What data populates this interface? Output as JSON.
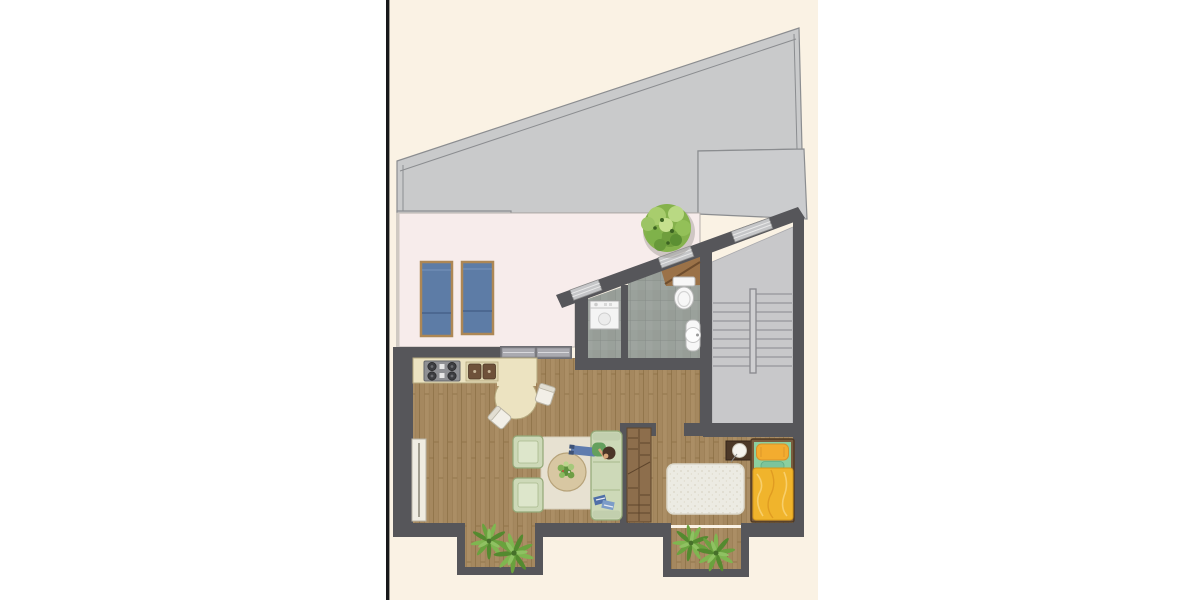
{
  "document": {
    "type": "architectural-floor-plan-render",
    "view": "top-down color floor plan of a small apartment with roof terrace",
    "visible_text": "none",
    "page_background": "#ffffff",
    "canvas_background": "#faf2e4",
    "divider_line_color": "#17171a"
  },
  "palette": {
    "wall": "#56565a",
    "roof": "#c9cacb",
    "roof_panel": "#cbccce",
    "roof_stroke": "#8b8d90",
    "terrace_floor": "#f7eceb",
    "wood_floor_base": "#a5885f",
    "tile_floor": "#9aa19b",
    "stair_floor": "#c8c8ca",
    "counter_cream": "#ece3c1",
    "green_furniture": "#cdd9b8",
    "green_furniture_border": "#93a877",
    "rug_beige": "#e7e1d1",
    "rug_white": "#ecebe3",
    "bed_yellow": "#f0b42c",
    "pillow_yellow": "#f3ac2f",
    "sheet_green": "#8ccf9f",
    "lounger_blue": "#5d7ca6",
    "lounger_frame": "#ad8755",
    "wardrobe_brown": "#8d6e4c",
    "nightstand_brown": "#4c3828",
    "door_brown": "#9b7248",
    "plant_green": "#6aa23e",
    "tree_green": "#85b24c",
    "white_fixture": "#f7f7f7"
  },
  "rooms": [
    {
      "id": "roof",
      "name": "sloped roof / covered area",
      "floor": "roof panels",
      "items": [
        "main sloped roof",
        "left roof panel",
        "right roof panel",
        "parapet edge lines"
      ]
    },
    {
      "id": "terrace",
      "name": "roof terrace",
      "floor": "pale pink screed",
      "items": [
        "sun lounger",
        "sun lounger",
        "potted tree"
      ]
    },
    {
      "id": "kitchen-living",
      "name": "kitchen / living room",
      "floor": "wood planks",
      "items": [
        "kitchen counter",
        "gas hob 4 burners",
        "double kitchen sink",
        "round dining table",
        "dining chair",
        "dining chair",
        "radiator",
        "armchair",
        "armchair",
        "beige rug",
        "round coffee table with plant",
        "sofa",
        "person lying on sofa",
        "books on sofa"
      ]
    },
    {
      "id": "laundry",
      "name": "utility room",
      "floor": "grey tiles",
      "items": [
        "washing machine"
      ]
    },
    {
      "id": "bathroom",
      "name": "bathroom",
      "floor": "grey tiles",
      "items": [
        "toilet",
        "washbasin"
      ]
    },
    {
      "id": "stairwell",
      "name": "stairwell",
      "floor": "light grey screed",
      "items": [
        "two stair flights",
        "center stringer rail"
      ]
    },
    {
      "id": "hallway",
      "name": "hallway",
      "floor": "wood planks",
      "items": []
    },
    {
      "id": "bedroom",
      "name": "bedroom",
      "floor": "wood planks",
      "items": [
        "open wardrobe",
        "white shag rug",
        "nightstand with lamp",
        "single bed with yellow bedding and pillows"
      ]
    },
    {
      "id": "niche-left",
      "name": "bay niche (living room)",
      "floor": "wood planks",
      "items": [
        "plant",
        "plant"
      ]
    },
    {
      "id": "niche-right",
      "name": "bay niche (bedroom)",
      "floor": "wood planks",
      "items": [
        "plant",
        "plant"
      ]
    }
  ],
  "openings": [
    {
      "id": "sliding-door",
      "name": "sliding glass door terrace-living",
      "panels": 2
    },
    {
      "id": "entry-door",
      "name": "entry door at angled wall",
      "leaf": "brown, shown open"
    },
    {
      "id": "window-1",
      "name": "window in angled wall (near stairs)"
    },
    {
      "id": "window-2",
      "name": "window in angled wall (above toilet)"
    },
    {
      "id": "window-3",
      "name": "window in angled wall (near laundry)"
    },
    {
      "id": "bedroom-door",
      "name": "door opening hallway-bedroom"
    }
  ]
}
